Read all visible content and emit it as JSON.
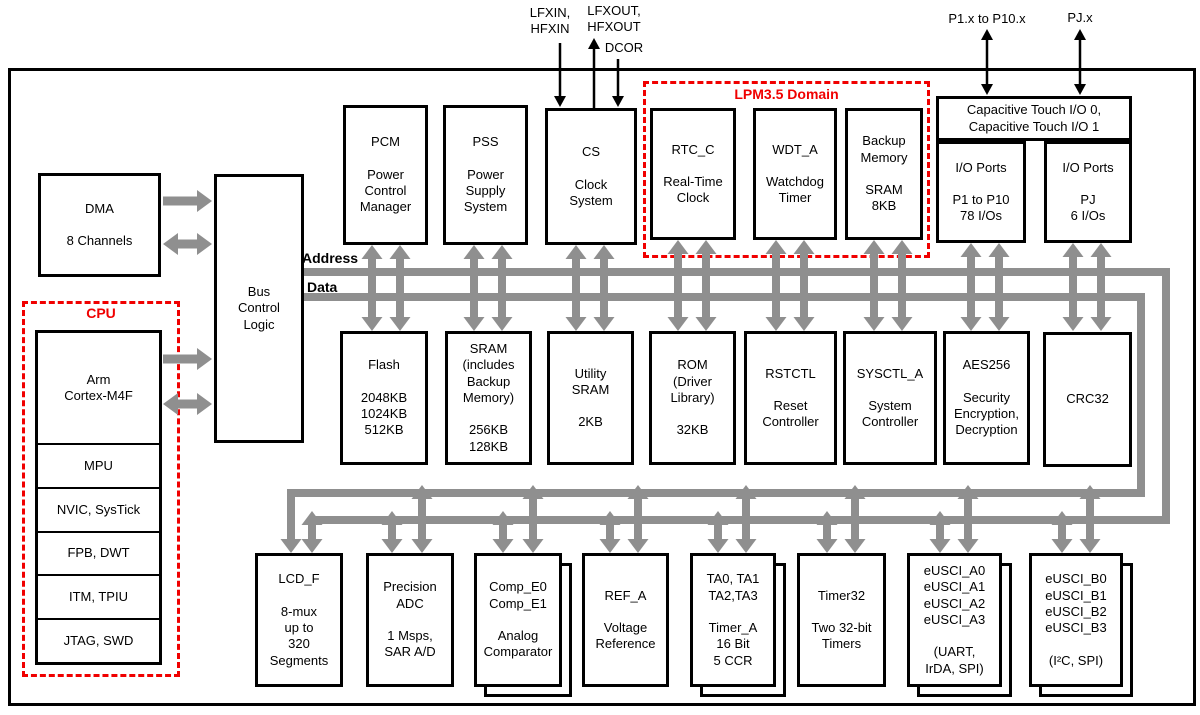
{
  "pins": {
    "lfxin": "LFXIN,\nHFXIN",
    "lfxout": "LFXOUT,\nHFXOUT",
    "dcor": "DCOR",
    "p1_to_p10": "P1.x to P10.x",
    "pj": "PJ.x"
  },
  "bus": {
    "address": "Address",
    "data": "Data"
  },
  "domains": {
    "cpu": "CPU",
    "lpm": "LPM3.5 Domain"
  },
  "cpu_sections": {
    "core": "Arm\nCortex-M4F",
    "mpu": "MPU",
    "nvic": "NVIC, SysTick",
    "fpb": "FPB, DWT",
    "itm": "ITM, TPIU",
    "jtag": "JTAG, SWD"
  },
  "blocks": {
    "dma": "DMA\n\n8 Channels",
    "bus_control": "Bus\nControl\nLogic",
    "pcm": "PCM\n\nPower\nControl\nManager",
    "pss": "PSS\n\nPower\nSupply\nSystem",
    "cs": "CS\n\nClock\nSystem",
    "rtc": "RTC_C\n\nReal-Time\nClock",
    "wdt": "WDT_A\n\nWatchdog\nTimer",
    "backup_memory": "Backup\nMemory\n\nSRAM\n8KB",
    "captouch": "Capacitive Touch I/O 0,\nCapacitive Touch I/O 1",
    "io_ports_p": "I/O Ports\n\nP1 to P10\n78 I/Os",
    "io_ports_pj": "I/O Ports\n\nPJ\n6 I/Os",
    "flash": "Flash\n\n2048KB\n1024KB\n512KB",
    "sram": "SRAM\n(includes\nBackup\nMemory)\n\n256KB\n128KB",
    "utility_sram": "Utility\nSRAM\n\n2KB",
    "rom": "ROM\n(Driver\nLibrary)\n\n32KB",
    "rstctl": "RSTCTL\n\nReset\nController",
    "sysctl": "SYSCTL_A\n\nSystem\nController",
    "aes256": "AES256\n\nSecurity\nEncryption,\nDecryption",
    "crc32": "CRC32",
    "lcd": "LCD_F\n\n8-mux\nup to\n320\nSegments",
    "adc": "Precision\nADC\n\n1 Msps,\nSAR A/D",
    "comp": "Comp_E0\nComp_E1\n\nAnalog\nComparator",
    "ref": "REF_A\n\nVoltage\nReference",
    "timer_a": "TA0, TA1\nTA2,TA3\n\nTimer_A\n16 Bit\n5 CCR",
    "timer32": "Timer32\n\nTwo 32-bit\nTimers",
    "eusci_a": "eUSCI_A0\neUSCI_A1\neUSCI_A2\neUSCI_A3\n\n(UART,\nIrDA, SPI)",
    "eusci_b": "eUSCI_B0\neUSCI_B1\neUSCI_B2\neUSCI_B3\n\n(I²C, SPI)"
  },
  "colors": {
    "accent_red": "#f00000",
    "bus_gray": "#8f8f8f"
  }
}
